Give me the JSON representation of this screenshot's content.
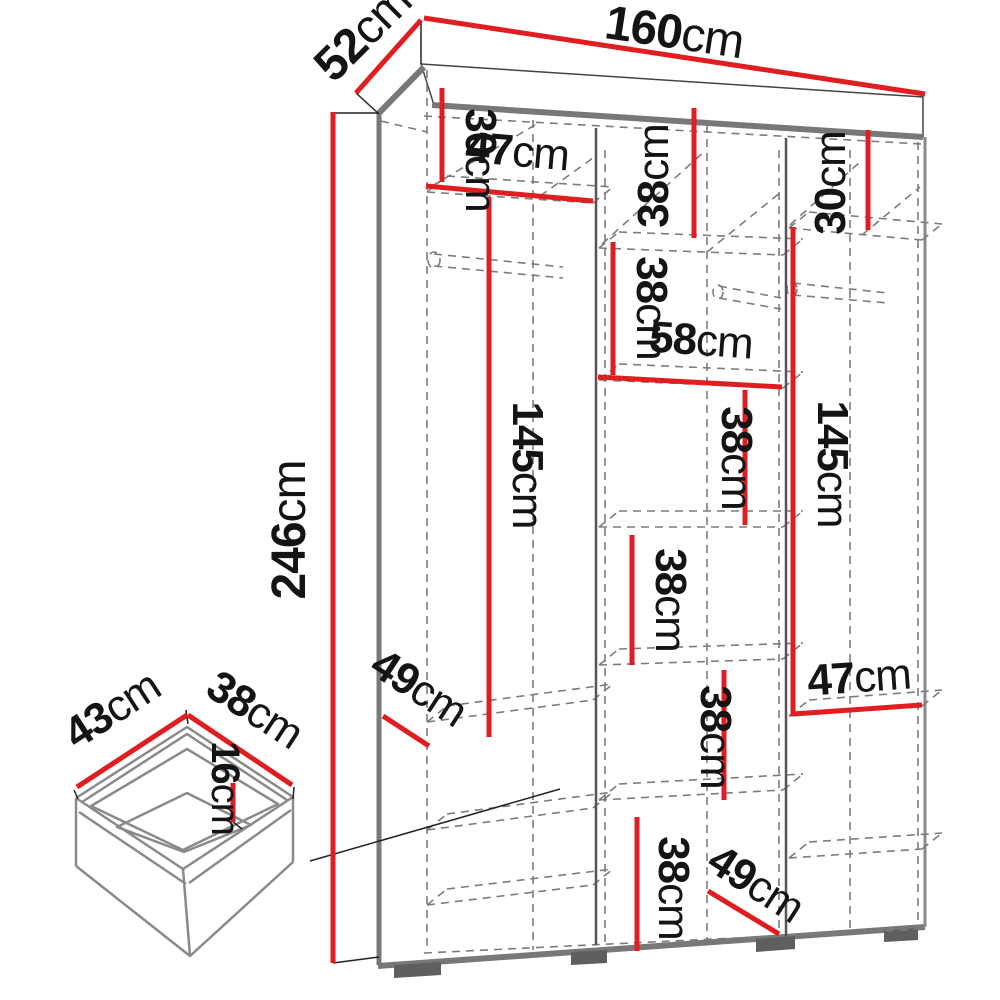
{
  "diagram": {
    "type": "wardrobe-dimension-diagram",
    "units": "cm",
    "colors": {
      "dimension_line": "#e01d20",
      "structure_gray": "#787878",
      "hidden_edge_dashed": "#7c7c7c",
      "label_text": "#141414",
      "background": "#ffffff"
    },
    "labels": {
      "overall_width": {
        "value": "160",
        "unit": "cm"
      },
      "overall_depth": {
        "value": "52",
        "unit": "cm"
      },
      "overall_height": {
        "value": "246",
        "unit": "cm"
      },
      "top_left_height": {
        "value": "30",
        "unit": "cm"
      },
      "left_shelf_width": {
        "value": "47",
        "unit": "cm"
      },
      "top_middle_height": {
        "value": "38",
        "unit": "cm"
      },
      "top_right_height": {
        "value": "30",
        "unit": "cm"
      },
      "mid_upper_height": {
        "value": "38",
        "unit": "cm"
      },
      "middle_shelf_width": {
        "value": "58",
        "unit": "cm"
      },
      "mid_center_height": {
        "value": "38",
        "unit": "cm"
      },
      "left_hanging_height": {
        "value": "145",
        "unit": "cm"
      },
      "right_hanging_height": {
        "value": "145",
        "unit": "cm"
      },
      "mid_lower_height": {
        "value": "38",
        "unit": "cm"
      },
      "lower_middle_height": {
        "value": "38",
        "unit": "cm"
      },
      "bottom_middle_height": {
        "value": "38",
        "unit": "cm"
      },
      "right_shelf_width": {
        "value": "47",
        "unit": "cm"
      },
      "left_shelf_depth": {
        "value": "49",
        "unit": "cm"
      },
      "bottom_shelf_depth": {
        "value": "49",
        "unit": "cm"
      },
      "drawer_width": {
        "value": "43",
        "unit": "cm"
      },
      "drawer_depth": {
        "value": "38",
        "unit": "cm"
      },
      "drawer_height": {
        "value": "16",
        "unit": "cm"
      }
    }
  }
}
